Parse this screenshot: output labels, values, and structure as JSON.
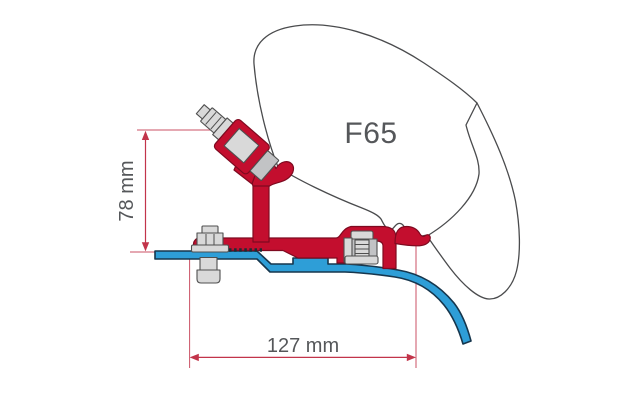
{
  "diagram": {
    "product_label": "F65",
    "dimensions": {
      "height": {
        "value": "78 mm"
      },
      "width": {
        "value": "127 mm"
      }
    },
    "colors": {
      "background": "#ffffff",
      "bracket_red": "#c30e2e",
      "bracket_red_dark": "#7e0a20",
      "roof_blue": "#2e9ed7",
      "roof_blue_dark": "#16364d",
      "hardware_gray": "#d9d9d9",
      "hardware_gray_dark": "#4f4f4f",
      "outline_gray": "#4a4b4d",
      "dimension_red": "#c2344a",
      "label_gray": "#55575a"
    }
  }
}
